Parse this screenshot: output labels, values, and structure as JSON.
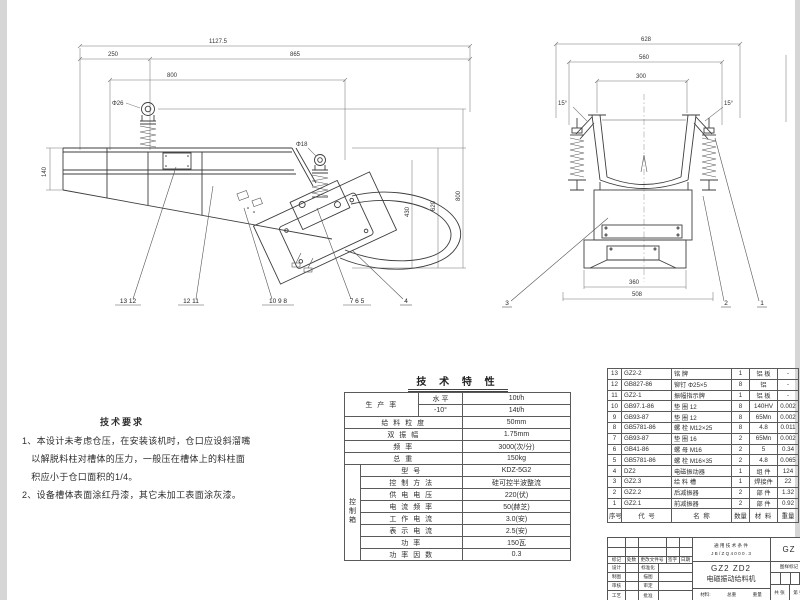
{
  "drawing": {
    "side_view": {
      "dim_overall": "1127.5",
      "dim_left": "250",
      "dim_right": "865",
      "dim_mid": "800",
      "hole_front": "Φ26",
      "hole_rear": "Φ18",
      "dim_height_left": "140",
      "dim_h1": "430",
      "dim_h2": "620",
      "dim_h3": "800",
      "callouts": [
        "13 12",
        "12 11",
        "10 9 8",
        "7 6 5",
        "4"
      ]
    },
    "end_view": {
      "dim_overall": "628",
      "dim_mid": "560",
      "dim_top_inner": "300",
      "angle_left": "15°",
      "angle_right": "15°",
      "dim_bottom_inner": "360",
      "dim_bottom_outer": "508",
      "callouts": [
        "3",
        "2",
        "1"
      ]
    }
  },
  "tech_requirements": {
    "title": "技术要求",
    "body": "1、本设计未考虑仓压，在安装该机时，仓口应设斜溜嘴\n　以解脱料柱对槽体的压力，一般压在槽体上的料柱面\n　积应小于仓口面积的1/4。\n2、设备槽体表面涂红丹漆，其它未加工表面涂灰漆。"
  },
  "tech_specs": {
    "title": "技 术 特 性",
    "production": {
      "label": "生 产 率",
      "rows": [
        {
          "cond": "水 平",
          "value": "10t/h"
        },
        {
          "cond": "-10°",
          "value": "14t/h"
        }
      ]
    },
    "simple_rows": [
      {
        "label": "给 料 粒 度",
        "value": "50mm"
      },
      {
        "label": "双 振 幅",
        "value": "1.75mm"
      },
      {
        "label": "频 率",
        "value": "3000(次/分)"
      },
      {
        "label": "总 重",
        "value": "150kg"
      }
    ],
    "control_box": {
      "group_label": "控\n制\n箱",
      "rows": [
        {
          "label": "型 号",
          "value": "KDZ-5G2"
        },
        {
          "label": "控 制 方 法",
          "value": "硅可控半波整流"
        },
        {
          "label": "供 电 电 压",
          "value": "220(伏)"
        },
        {
          "label": "电 流 频 率",
          "value": "50(赫芝)"
        },
        {
          "label": "工 作 电 流",
          "value": "3.0(安)"
        },
        {
          "label": "表 示 电 流",
          "value": "2.5(安)"
        },
        {
          "label": "功 率",
          "value": "150瓦"
        },
        {
          "label": "功 率 因 数",
          "value": "0.3"
        }
      ]
    }
  },
  "bom": {
    "headers": [
      "序号",
      "代 号",
      "名 称",
      "数量",
      "材 料",
      "重量"
    ],
    "rows": [
      [
        "13",
        "GZ2-2",
        "铭 牌",
        "1",
        "铝 板",
        "-"
      ],
      [
        "12",
        "GB827-86",
        "铆钉 Φ25×5",
        "8",
        "铝",
        "-"
      ],
      [
        "11",
        "GZ2-1",
        "振幅指示牌",
        "1",
        "铝 板",
        "-"
      ],
      [
        "10",
        "GB97.1-86",
        "垫 圈 12",
        "8",
        "140HV",
        "0.002"
      ],
      [
        "9",
        "GB93-87",
        "垫 圈 12",
        "8",
        "65Mn",
        "0.002"
      ],
      [
        "8",
        "GB5781-86",
        "螺 栓 M12×25",
        "8",
        "4.8",
        "0.011"
      ],
      [
        "7",
        "GB93-87",
        "垫 圈 16",
        "2",
        "65Mn",
        "0.002"
      ],
      [
        "6",
        "GB41-86",
        "螺 母 M16",
        "2",
        "5",
        "0.34"
      ],
      [
        "5",
        "GB5781-86",
        "螺 栓 M16×35",
        "2",
        "4.8",
        "0.065"
      ],
      [
        "4",
        "DZ2",
        "电磁振动器",
        "1",
        "组 件",
        "124"
      ],
      [
        "3",
        "GZ2.3",
        "给 料 槽",
        "1",
        "焊接件",
        "22"
      ],
      [
        "2",
        "GZ2.2",
        "后减振器",
        "2",
        "部 件",
        "1.32"
      ],
      [
        "1",
        "GZ2.1",
        "前减振器",
        "2",
        "部 件",
        "0.92"
      ]
    ]
  },
  "title_block": {
    "rev_cols": [
      "标记",
      "处数",
      "更改文件号",
      "签字",
      "日期"
    ],
    "sign_left": [
      "设计",
      "制图",
      "审核",
      "工艺"
    ],
    "sign_right": [
      "标准化",
      "描图",
      "审定",
      "批准"
    ],
    "general_spec_line1": "通 用 技 术 条 件",
    "general_spec_line2": "J B / Z Q 4 0 0 0 . 3",
    "model": "GZ2 ZD2",
    "name": "电磁振动给料机",
    "mat_label": "材料:",
    "weight_label": "总重",
    "scale_label": "重量",
    "doc_no": "GZ",
    "mark_label": "图样标记",
    "sheets_label": "共 张",
    "page_label": "第 张"
  }
}
